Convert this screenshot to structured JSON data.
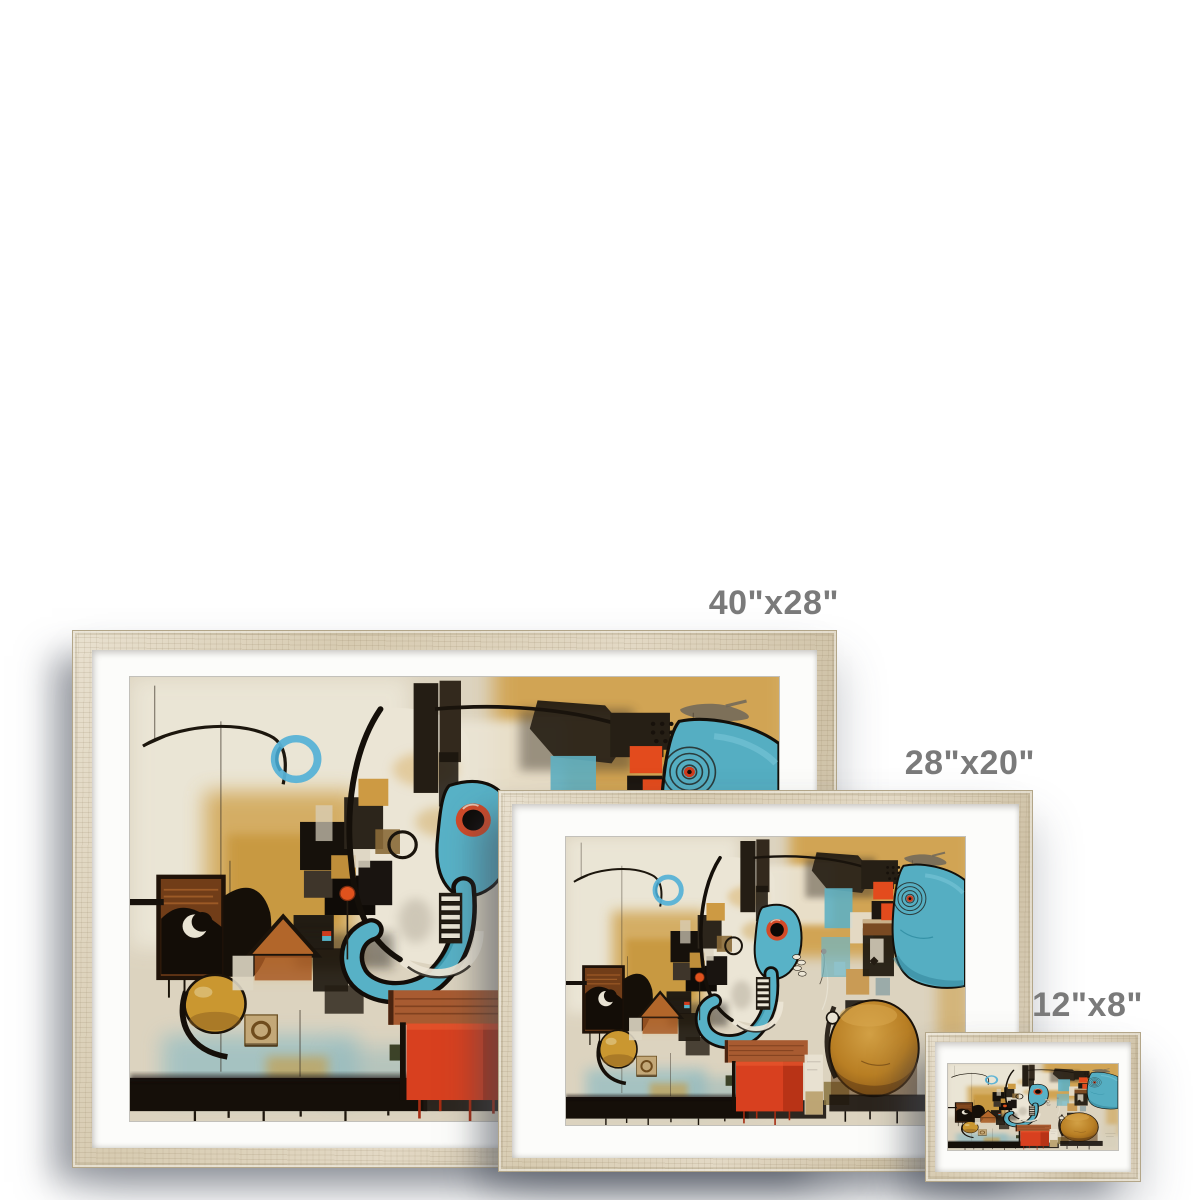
{
  "page": {
    "background_color": "#ffffff"
  },
  "sizes": [
    {
      "label": "40\"x28\""
    },
    {
      "label": "28\"x20\""
    },
    {
      "label": "12\"x8\""
    }
  ],
  "frame_style": {
    "wood_color": "#d9cdb4",
    "mat_color": "#fcfcfa",
    "label_color": "#7a7a7a"
  },
  "artwork": {
    "name": "Abstract cubist elephant painting",
    "palette": {
      "canvas_cream": "#dcd3bf",
      "ochre": "#cfa04a",
      "teal": "#57b1c6",
      "orange_red": "#d8401f",
      "ink_black": "#17110b",
      "amber": "#b97f24",
      "rust": "#a85b31",
      "powder_blue": "#9cc0c2"
    }
  }
}
